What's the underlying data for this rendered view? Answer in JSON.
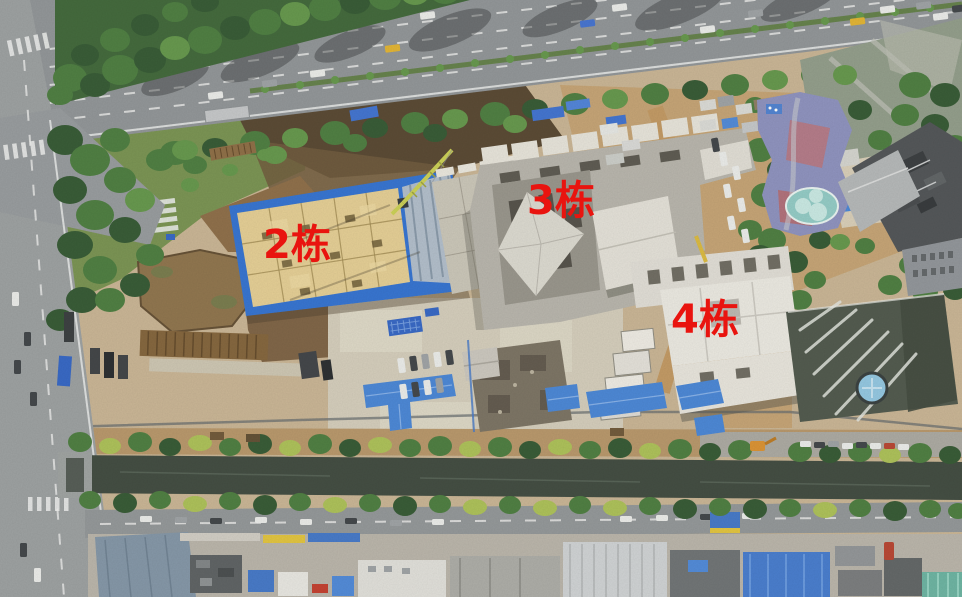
{
  "scene": {
    "labels": [
      {
        "id": "building-2",
        "text": "2栋"
      },
      {
        "id": "building-3",
        "text": "3栋"
      },
      {
        "id": "building-4",
        "text": "4栋"
      }
    ],
    "label_color": "#e9140f"
  },
  "palette": {
    "road_asphalt": "#8d9296",
    "tree_green": "#3f6b39",
    "site_dirt": "#c2a172",
    "formwork_yellow": "#e3cd93",
    "safety_blue": "#2e6fd1",
    "metal_roof_blue": "#4483d6",
    "concrete_grey": "#b5b3ab",
    "white_building": "#e9e8e2",
    "canal_water": "#3a463d",
    "pond_water": "#8b7049"
  }
}
